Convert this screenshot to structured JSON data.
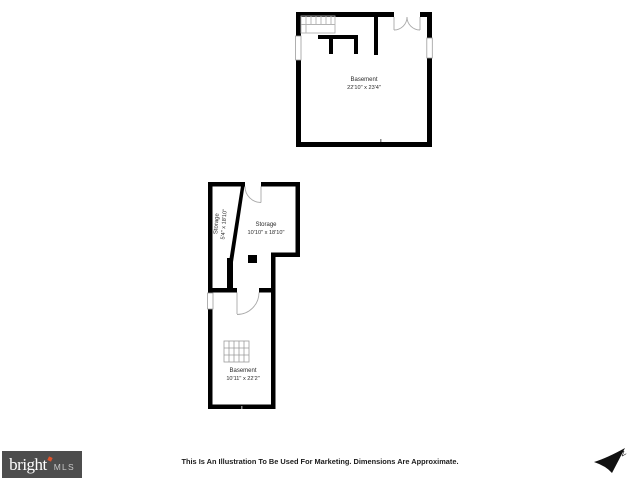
{
  "floorplan": {
    "rooms": [
      {
        "name": "Basement",
        "dims": "22'10\" x 23'4\""
      },
      {
        "name": "Storage",
        "dims": "5'4\" x 18'10\""
      },
      {
        "name": "Storage",
        "dims": "10'10\" x 18'10\""
      },
      {
        "name": "Basement",
        "dims": "10'11\" x 22'2\""
      }
    ]
  },
  "footer": {
    "disclaimer": "This Is An Illustration To Be Used For Marketing. Dimensions Are Approximate.",
    "logo": {
      "brand": "bright",
      "suffix": "MLS"
    },
    "compass_label": "N"
  },
  "colors": {
    "wall": "#000000",
    "detail_gray": "#a8a8a8",
    "logo_bg": "#4d4d4d",
    "logo_accent": "#e0542b"
  }
}
